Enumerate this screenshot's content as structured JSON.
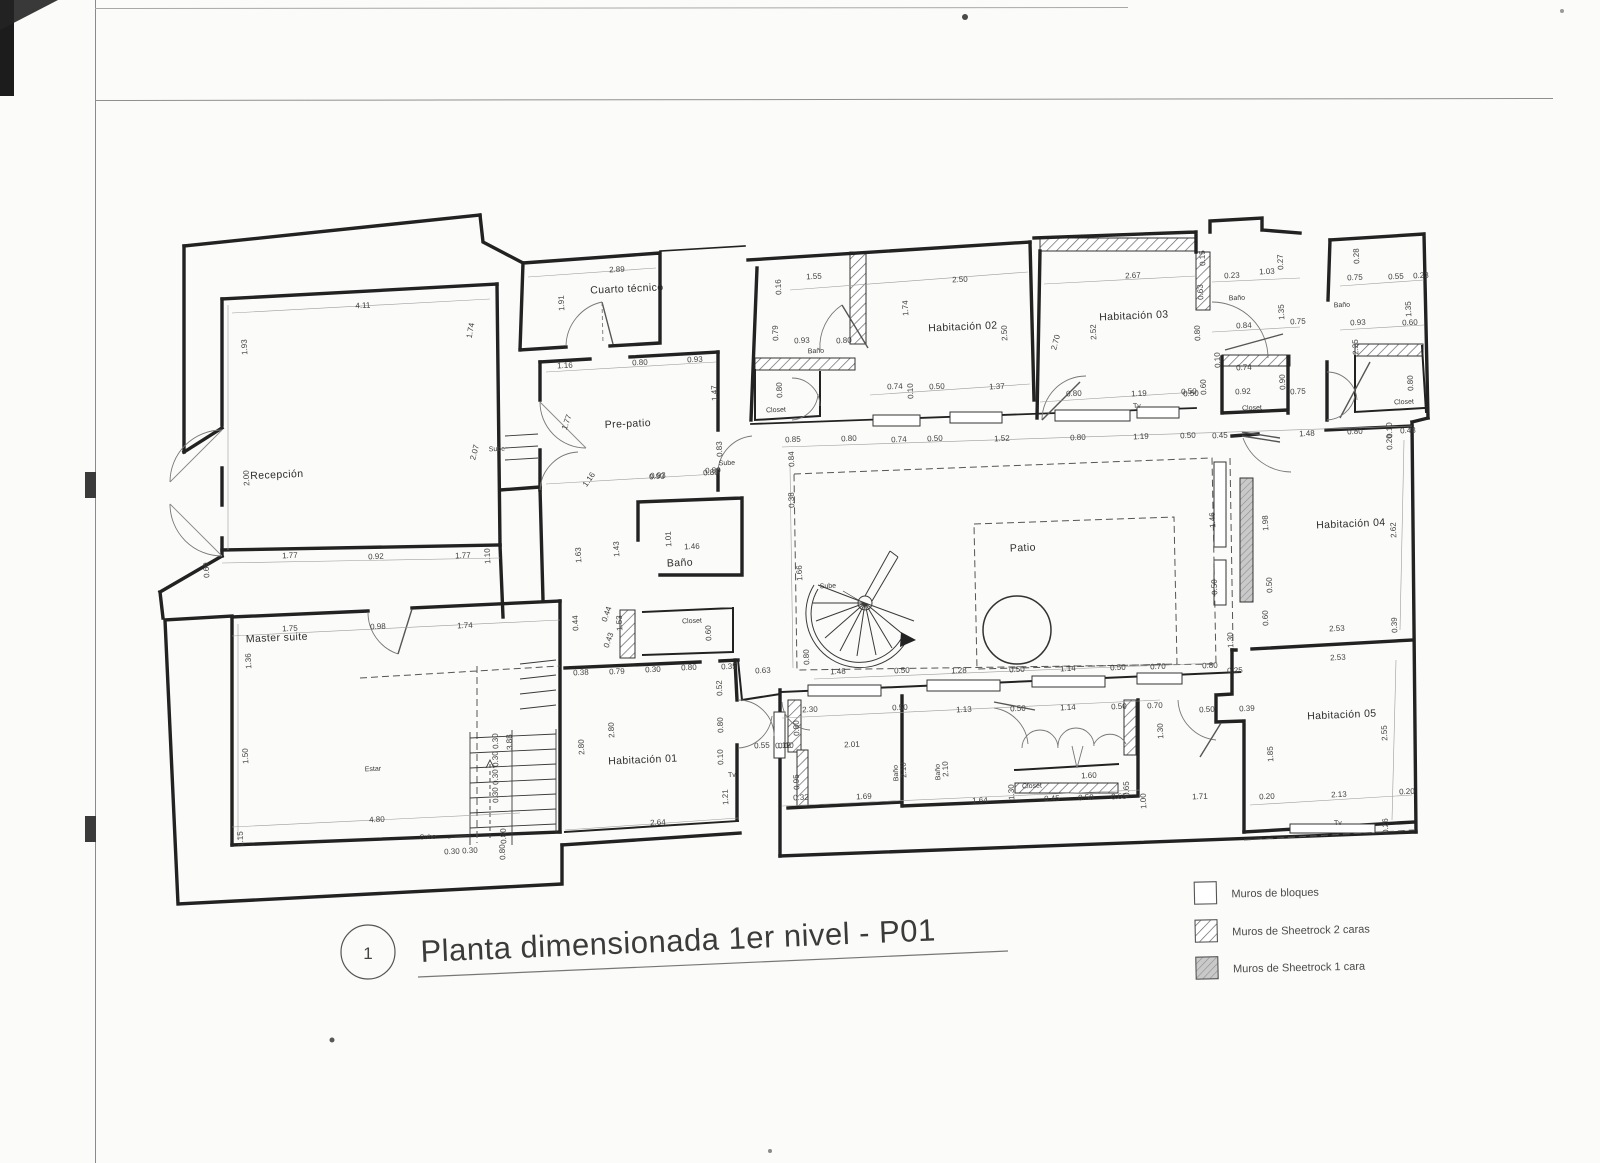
{
  "title_block": {
    "number": "1",
    "title": "Planta dimensionada 1er nivel - P01"
  },
  "legend": {
    "items": [
      {
        "label": "Muros de bloques",
        "style": "blocks"
      },
      {
        "label": "Muros de Sheetrock 2 caras",
        "style": "hatch-2-sides"
      },
      {
        "label": "Muros de Sheetrock 1 cara",
        "style": "hatch-1-side"
      }
    ]
  },
  "plan": {
    "labels": [
      {
        "t": "Recepción",
        "x": 277,
        "y": 478,
        "c": "room"
      },
      {
        "t": "Master suite",
        "x": 277,
        "y": 641,
        "c": "room"
      },
      {
        "t": "Cuarto técnico",
        "x": 627,
        "y": 292,
        "c": "room"
      },
      {
        "t": "Pre-patio",
        "x": 628,
        "y": 427,
        "c": "room"
      },
      {
        "t": "Baño",
        "x": 680,
        "y": 566,
        "c": "room"
      },
      {
        "t": "Habitación 01",
        "x": 643,
        "y": 763,
        "c": "room"
      },
      {
        "t": "Habitación 02",
        "x": 963,
        "y": 330,
        "c": "room"
      },
      {
        "t": "Habitación 03",
        "x": 1134,
        "y": 319,
        "c": "room"
      },
      {
        "t": "Habitación 04",
        "x": 1351,
        "y": 527,
        "c": "room"
      },
      {
        "t": "Habitación 05",
        "x": 1342,
        "y": 718,
        "c": "room"
      },
      {
        "t": "Patio",
        "x": 1023,
        "y": 551,
        "c": "room"
      },
      {
        "t": "Estar",
        "x": 373,
        "y": 771,
        "c": "s"
      },
      {
        "t": "Baño",
        "x": 816,
        "y": 353,
        "c": "s"
      },
      {
        "t": "Closet",
        "x": 776,
        "y": 412,
        "c": "s"
      },
      {
        "t": "Baño",
        "x": 1237,
        "y": 300,
        "c": "s"
      },
      {
        "t": "Closet",
        "x": 1252,
        "y": 410,
        "c": "s"
      },
      {
        "t": "Tv",
        "x": 1137,
        "y": 408,
        "c": "s"
      },
      {
        "t": "Baño",
        "x": 1342,
        "y": 307,
        "c": "s"
      },
      {
        "t": "Closet",
        "x": 1404,
        "y": 404,
        "c": "s"
      },
      {
        "t": "Closet",
        "x": 692,
        "y": 623,
        "c": "s"
      },
      {
        "t": "Closet",
        "x": 1032,
        "y": 788,
        "c": "s"
      },
      {
        "t": "Sube",
        "x": 497,
        "y": 451,
        "c": "s"
      },
      {
        "t": "Sube",
        "x": 727,
        "y": 465,
        "c": "s"
      },
      {
        "t": "Sube",
        "x": 828,
        "y": 588,
        "c": "s"
      },
      {
        "t": "Sube",
        "x": 428,
        "y": 839,
        "c": "s"
      },
      {
        "t": "Tv",
        "x": 1338,
        "y": 825,
        "c": "s"
      },
      {
        "t": "Tv",
        "x": 732,
        "y": 777,
        "c": "s"
      },
      {
        "t": "Baño",
        "x": 898,
        "y": 773,
        "c": "sv"
      },
      {
        "t": "Baño",
        "x": 940,
        "y": 772,
        "c": "sv"
      }
    ],
    "dims": [
      {
        "t": "2.89",
        "x": 617,
        "y": 272,
        "o": "h"
      },
      {
        "t": "1.91",
        "x": 564,
        "y": 303,
        "o": "v"
      },
      {
        "t": "1.55",
        "x": 814,
        "y": 279,
        "o": "h"
      },
      {
        "t": "0.16",
        "x": 781,
        "y": 287,
        "o": "v"
      },
      {
        "t": "2.50",
        "x": 960,
        "y": 282,
        "o": "h"
      },
      {
        "t": "1.74",
        "x": 908,
        "y": 308,
        "o": "v"
      },
      {
        "t": "2.50",
        "x": 1007,
        "y": 333,
        "o": "v"
      },
      {
        "t": "2.67",
        "x": 1133,
        "y": 278,
        "o": "h"
      },
      {
        "t": "2.52",
        "x": 1096,
        "y": 332,
        "o": "v"
      },
      {
        "t": "2.70",
        "x": 1058,
        "y": 343,
        "o": -75
      },
      {
        "t": "0.15",
        "x": 1205,
        "y": 258,
        "o": "v"
      },
      {
        "t": "0.23",
        "x": 1232,
        "y": 278,
        "o": "h"
      },
      {
        "t": "1.03",
        "x": 1267,
        "y": 274,
        "o": "h"
      },
      {
        "t": "0.27",
        "x": 1283,
        "y": 262,
        "o": "v"
      },
      {
        "t": "0.63",
        "x": 1203,
        "y": 292,
        "o": "v"
      },
      {
        "t": "0.28",
        "x": 1359,
        "y": 256,
        "o": "v"
      },
      {
        "t": "0.75",
        "x": 1355,
        "y": 280,
        "o": "h"
      },
      {
        "t": "0.55",
        "x": 1396,
        "y": 279,
        "o": "h"
      },
      {
        "t": "0.23",
        "x": 1421,
        "y": 278,
        "o": "h"
      },
      {
        "t": "1.35",
        "x": 1284,
        "y": 312,
        "o": "v"
      },
      {
        "t": "1.35",
        "x": 1411,
        "y": 309,
        "o": "v"
      },
      {
        "t": "0.84",
        "x": 1244,
        "y": 328,
        "o": "h"
      },
      {
        "t": "0.75",
        "x": 1298,
        "y": 324,
        "o": "h"
      },
      {
        "t": "0.93",
        "x": 1358,
        "y": 325,
        "o": "h"
      },
      {
        "t": "0.60",
        "x": 1410,
        "y": 325,
        "o": "h"
      },
      {
        "t": "2.25",
        "x": 1358,
        "y": 347,
        "o": "v"
      },
      {
        "t": "0.80",
        "x": 1200,
        "y": 333,
        "o": "v"
      },
      {
        "t": "0.10",
        "x": 1220,
        "y": 360,
        "o": "v"
      },
      {
        "t": "0.74",
        "x": 1244,
        "y": 370,
        "o": "h"
      },
      {
        "t": "0.92",
        "x": 1243,
        "y": 394,
        "o": "h"
      },
      {
        "t": "0.90",
        "x": 1285,
        "y": 382,
        "o": "v"
      },
      {
        "t": "0.75",
        "x": 1298,
        "y": 394,
        "o": "h"
      },
      {
        "t": "0.50",
        "x": 1191,
        "y": 396,
        "o": "h"
      },
      {
        "t": "0.60",
        "x": 1206,
        "y": 387,
        "o": "v"
      },
      {
        "t": "0.80",
        "x": 1413,
        "y": 383,
        "o": "v"
      },
      {
        "t": "4.11",
        "x": 363,
        "y": 308,
        "o": "h"
      },
      {
        "t": "1.93",
        "x": 247,
        "y": 347,
        "o": "v"
      },
      {
        "t": "1.74",
        "x": 473,
        "y": 331,
        "o": -80
      },
      {
        "t": "2.00",
        "x": 249,
        "y": 478,
        "o": "v"
      },
      {
        "t": "2.07",
        "x": 477,
        "y": 453,
        "o": -75
      },
      {
        "t": "0.69",
        "x": 209,
        "y": 570,
        "o": "v"
      },
      {
        "t": "1.77",
        "x": 290,
        "y": 558,
        "o": "h"
      },
      {
        "t": "0.92",
        "x": 376,
        "y": 559,
        "o": "h"
      },
      {
        "t": "1.77",
        "x": 463,
        "y": 558,
        "o": "h"
      },
      {
        "t": "1.10",
        "x": 490,
        "y": 556,
        "o": "v"
      },
      {
        "t": "1.16",
        "x": 565,
        "y": 368,
        "o": "h"
      },
      {
        "t": "0.80",
        "x": 640,
        "y": 365,
        "o": "h"
      },
      {
        "t": "0.93",
        "x": 695,
        "y": 362,
        "o": "h"
      },
      {
        "t": "1.47",
        "x": 717,
        "y": 393,
        "o": "v"
      },
      {
        "t": "1.77",
        "x": 569,
        "y": 423,
        "o": -70
      },
      {
        "t": "1.16",
        "x": 591,
        "y": 481,
        "o": -55
      },
      {
        "t": "0.93",
        "x": 658,
        "y": 478,
        "o": "h"
      },
      {
        "t": "0.80",
        "x": 713,
        "y": 473,
        "o": "h"
      },
      {
        "t": "0.83",
        "x": 722,
        "y": 449,
        "o": "v"
      },
      {
        "t": "1.63",
        "x": 581,
        "y": 555,
        "o": "v"
      },
      {
        "t": "1.43",
        "x": 619,
        "y": 549,
        "o": "v"
      },
      {
        "t": "0.79",
        "x": 778,
        "y": 333,
        "o": "v"
      },
      {
        "t": "0.93",
        "x": 802,
        "y": 343,
        "o": "h"
      },
      {
        "t": "0.80",
        "x": 844,
        "y": 343,
        "o": "h"
      },
      {
        "t": "0.80",
        "x": 782,
        "y": 390,
        "o": "v"
      },
      {
        "t": "0.74",
        "x": 895,
        "y": 389,
        "o": "h"
      },
      {
        "t": "0.10",
        "x": 913,
        "y": 391,
        "o": "v"
      },
      {
        "t": "0.50",
        "x": 937,
        "y": 389,
        "o": "h"
      },
      {
        "t": "1.37",
        "x": 997,
        "y": 389,
        "o": "h"
      },
      {
        "t": "0.80",
        "x": 1074,
        "y": 396,
        "o": "h"
      },
      {
        "t": "1.19",
        "x": 1139,
        "y": 396,
        "o": "h"
      },
      {
        "t": "0.50",
        "x": 1189,
        "y": 394,
        "o": "h"
      },
      {
        "t": "0.85",
        "x": 793,
        "y": 442,
        "o": "h"
      },
      {
        "t": "0.80",
        "x": 849,
        "y": 441,
        "o": "h"
      },
      {
        "t": "0.74",
        "x": 899,
        "y": 442,
        "o": "h"
      },
      {
        "t": "0.50",
        "x": 935,
        "y": 441,
        "o": "h"
      },
      {
        "t": "1.52",
        "x": 1002,
        "y": 441,
        "o": "h"
      },
      {
        "t": "0.80",
        "x": 1078,
        "y": 440,
        "o": "h"
      },
      {
        "t": "1.19",
        "x": 1141,
        "y": 439,
        "o": "h"
      },
      {
        "t": "0.50",
        "x": 1188,
        "y": 438,
        "o": "h"
      },
      {
        "t": "0.45",
        "x": 1220,
        "y": 438,
        "o": "h"
      },
      {
        "t": "1.48",
        "x": 1307,
        "y": 436,
        "o": "h"
      },
      {
        "t": "0.80",
        "x": 1355,
        "y": 434,
        "o": "h"
      },
      {
        "t": "0.10",
        "x": 1392,
        "y": 430,
        "o": "v"
      },
      {
        "t": "0.20",
        "x": 1392,
        "y": 442,
        "o": "v"
      },
      {
        "t": "0.48",
        "x": 1408,
        "y": 433,
        "o": "h"
      },
      {
        "t": "0.84",
        "x": 794,
        "y": 459,
        "o": "v"
      },
      {
        "t": "0.38",
        "x": 794,
        "y": 500,
        "o": "v"
      },
      {
        "t": "1.66",
        "x": 802,
        "y": 573,
        "o": "v"
      },
      {
        "t": "0.80",
        "x": 809,
        "y": 657,
        "o": "v"
      },
      {
        "t": "1.48",
        "x": 838,
        "y": 674,
        "o": "h"
      },
      {
        "t": "0.50",
        "x": 902,
        "y": 673,
        "o": "h"
      },
      {
        "t": "1.28",
        "x": 959,
        "y": 673,
        "o": "h"
      },
      {
        "t": "0.50",
        "x": 1017,
        "y": 672,
        "o": "h"
      },
      {
        "t": "1.14",
        "x": 1068,
        "y": 671,
        "o": "h"
      },
      {
        "t": "0.50",
        "x": 1118,
        "y": 670,
        "o": "h"
      },
      {
        "t": "0.70",
        "x": 1158,
        "y": 669,
        "o": "h"
      },
      {
        "t": "0.80",
        "x": 1210,
        "y": 668,
        "o": "h"
      },
      {
        "t": "1.46",
        "x": 1215,
        "y": 520,
        "o": "v"
      },
      {
        "t": "0.50",
        "x": 1217,
        "y": 587,
        "o": "v"
      },
      {
        "t": "1.98",
        "x": 1268,
        "y": 523,
        "o": "v"
      },
      {
        "t": "0.50",
        "x": 1272,
        "y": 585,
        "o": "v"
      },
      {
        "t": "0.60",
        "x": 1268,
        "y": 618,
        "o": "v"
      },
      {
        "t": "1.30",
        "x": 1233,
        "y": 640,
        "o": "v"
      },
      {
        "t": "2.62",
        "x": 1396,
        "y": 530,
        "o": "v"
      },
      {
        "t": "2.53",
        "x": 1337,
        "y": 631,
        "o": "h"
      },
      {
        "t": "0.39",
        "x": 1397,
        "y": 625,
        "o": "v"
      },
      {
        "t": "2.53",
        "x": 1338,
        "y": 660,
        "o": "h"
      },
      {
        "t": "2.55",
        "x": 1387,
        "y": 733,
        "o": "v"
      },
      {
        "t": "1.85",
        "x": 1273,
        "y": 754,
        "o": "v"
      },
      {
        "t": "0.20",
        "x": 1267,
        "y": 799,
        "o": "h"
      },
      {
        "t": "2.13",
        "x": 1339,
        "y": 797,
        "o": "h"
      },
      {
        "t": "0.20",
        "x": 1407,
        "y": 794,
        "o": "h"
      },
      {
        "t": "0.26",
        "x": 1388,
        "y": 826,
        "o": "v"
      },
      {
        "t": "0.25",
        "x": 1235,
        "y": 673,
        "o": "h"
      },
      {
        "t": "0.50",
        "x": 1207,
        "y": 712,
        "o": "h"
      },
      {
        "t": "0.39",
        "x": 1247,
        "y": 711,
        "o": "h"
      },
      {
        "t": "1.71",
        "x": 1200,
        "y": 799,
        "o": "h"
      },
      {
        "t": "1.30",
        "x": 1163,
        "y": 731,
        "o": "v"
      },
      {
        "t": "1.00",
        "x": 1146,
        "y": 801,
        "o": "v"
      },
      {
        "t": "2.30",
        "x": 810,
        "y": 712,
        "o": "h"
      },
      {
        "t": "0.50",
        "x": 900,
        "y": 710,
        "o": "h"
      },
      {
        "t": "1.13",
        "x": 964,
        "y": 712,
        "o": "h"
      },
      {
        "t": "0.50",
        "x": 1018,
        "y": 711,
        "o": "h"
      },
      {
        "t": "1.14",
        "x": 1068,
        "y": 710,
        "o": "h"
      },
      {
        "t": "0.50",
        "x": 1119,
        "y": 709,
        "o": "h"
      },
      {
        "t": "0.70",
        "x": 1155,
        "y": 708,
        "o": "h"
      },
      {
        "t": "0.80",
        "x": 799,
        "y": 728,
        "o": "v"
      },
      {
        "t": "2.01",
        "x": 852,
        "y": 747,
        "o": "h"
      },
      {
        "t": "0.10",
        "x": 786,
        "y": 748,
        "o": "h"
      },
      {
        "t": "0.95",
        "x": 799,
        "y": 782,
        "o": "v"
      },
      {
        "t": "0.32",
        "x": 801,
        "y": 800,
        "o": "h"
      },
      {
        "t": "1.69",
        "x": 864,
        "y": 799,
        "o": "h"
      },
      {
        "t": "1.64",
        "x": 980,
        "y": 803,
        "o": "h"
      },
      {
        "t": "2.10",
        "x": 906,
        "y": 770,
        "o": "v"
      },
      {
        "t": "2.10",
        "x": 948,
        "y": 769,
        "o": "v"
      },
      {
        "t": "1.30",
        "x": 1014,
        "y": 792,
        "o": "v"
      },
      {
        "t": "1.60",
        "x": 1089,
        "y": 778,
        "o": "h"
      },
      {
        "t": "0.45",
        "x": 1052,
        "y": 801,
        "o": "h"
      },
      {
        "t": "0.50",
        "x": 1086,
        "y": 800,
        "o": "h"
      },
      {
        "t": "0.65",
        "x": 1119,
        "y": 799,
        "o": "h"
      },
      {
        "t": "0.65",
        "x": 1129,
        "y": 789,
        "o": "v"
      },
      {
        "t": "0.38",
        "x": 581,
        "y": 675,
        "o": "h"
      },
      {
        "t": "0.79",
        "x": 617,
        "y": 674,
        "o": "h"
      },
      {
        "t": "0.30",
        "x": 653,
        "y": 672,
        "o": "h"
      },
      {
        "t": "0.80",
        "x": 689,
        "y": 670,
        "o": "h"
      },
      {
        "t": "0.35",
        "x": 729,
        "y": 669,
        "o": "h"
      },
      {
        "t": "0.63",
        "x": 763,
        "y": 673,
        "o": "h"
      },
      {
        "t": "2.80",
        "x": 584,
        "y": 747,
        "o": "v"
      },
      {
        "t": "2.80",
        "x": 614,
        "y": 730,
        "o": "v"
      },
      {
        "t": "2.64",
        "x": 658,
        "y": 825,
        "o": "h"
      },
      {
        "t": "0.80",
        "x": 723,
        "y": 725,
        "o": "v"
      },
      {
        "t": "0.10",
        "x": 723,
        "y": 757,
        "o": "v"
      },
      {
        "t": "1.21",
        "x": 728,
        "y": 797,
        "o": "v"
      },
      {
        "t": "0.55",
        "x": 762,
        "y": 748,
        "o": "h"
      },
      {
        "t": "0.12",
        "x": 783,
        "y": 748,
        "o": "h"
      },
      {
        "t": "0.52",
        "x": 722,
        "y": 688,
        "o": "v"
      },
      {
        "t": "0.93",
        "x": 657,
        "y": 479,
        "o": "h"
      },
      {
        "t": "0.80",
        "x": 711,
        "y": 475,
        "o": "h"
      },
      {
        "t": "1.01",
        "x": 671,
        "y": 539,
        "o": "v"
      },
      {
        "t": "1.46",
        "x": 692,
        "y": 549,
        "o": "h"
      },
      {
        "t": "0.44",
        "x": 578,
        "y": 623,
        "o": "v"
      },
      {
        "t": "0.44",
        "x": 609,
        "y": 615,
        "o": -70
      },
      {
        "t": "0.43",
        "x": 611,
        "y": 641,
        "o": -70
      },
      {
        "t": "1.53",
        "x": 622,
        "y": 623,
        "o": "v"
      },
      {
        "t": "0.60",
        "x": 711,
        "y": 633,
        "o": "v"
      },
      {
        "t": "1.75",
        "x": 290,
        "y": 631,
        "o": "h"
      },
      {
        "t": "0.98",
        "x": 378,
        "y": 629,
        "o": "h"
      },
      {
        "t": "1.74",
        "x": 465,
        "y": 628,
        "o": "h"
      },
      {
        "t": "1.36",
        "x": 251,
        "y": 661,
        "o": "v"
      },
      {
        "t": "1.50",
        "x": 248,
        "y": 756,
        "o": "v"
      },
      {
        "t": "1.15",
        "x": 243,
        "y": 839,
        "o": "v"
      },
      {
        "t": "4.80",
        "x": 377,
        "y": 822,
        "o": "h"
      },
      {
        "t": "0.30",
        "x": 452,
        "y": 854,
        "o": "h"
      },
      {
        "t": "0.30",
        "x": 470,
        "y": 853,
        "o": "h"
      },
      {
        "t": "0.80",
        "x": 505,
        "y": 852,
        "o": "v"
      },
      {
        "t": "0.80",
        "x": 506,
        "y": 836,
        "o": "v"
      },
      {
        "t": "3.88",
        "x": 512,
        "y": 742,
        "o": "v"
      },
      {
        "t": "0.30",
        "x": 498,
        "y": 741,
        "o": "v"
      },
      {
        "t": "0.30",
        "x": 498,
        "y": 759,
        "o": "v"
      },
      {
        "t": "0.30",
        "x": 498,
        "y": 777,
        "o": "v"
      },
      {
        "t": "0.30",
        "x": 498,
        "y": 795,
        "o": "v"
      }
    ]
  }
}
